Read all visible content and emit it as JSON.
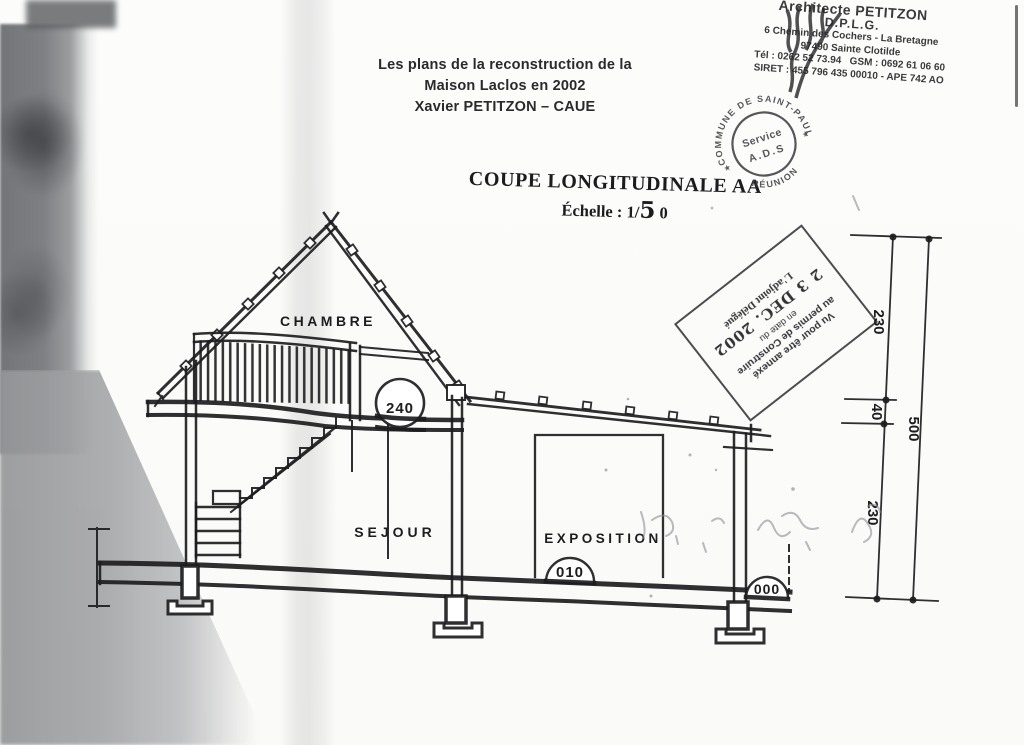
{
  "letterhead": {
    "name": "Architecte PETITZON",
    "dplg": "D.P.L.G.",
    "address1": "6 Chemin des Cochers - La Bretagne",
    "address2": "97490 Sainte Clotilde",
    "phone": "Tél : 0262 52 73.94",
    "gsm": "GSM : 0692 61 06 60",
    "siret": "SIRET : 455 796 435 00010 - APE 742 AO"
  },
  "title_block": {
    "line1": "Les plans de la reconstruction de la",
    "line2": "Maison Laclos en 2002",
    "line3": "Xavier PETITZON – CAUE"
  },
  "drawing": {
    "title": "COUPE LONGITUDINALE AA",
    "scale_prefix": "Échelle : 1/",
    "scale_hand": "5",
    "scale_suffix": "0",
    "rooms": {
      "chambre": "CHAMBRE",
      "sejour": "SEJOUR",
      "exposition": "EXPOSITION"
    },
    "levels": {
      "mezzanine": "240",
      "floor": "010",
      "ground": "000"
    },
    "dims": {
      "upper": "230",
      "middle": "40",
      "lower": "230",
      "total": "500"
    }
  },
  "stamps": {
    "round": {
      "arc_top": "COMMUNE DE SAINT-PAUL",
      "arc_bottom": "RÉUNION",
      "inner1": "Service",
      "inner2": "A.D.S",
      "star": "★"
    },
    "date": {
      "line1": "Vu pour être annexé",
      "line2": "au permis de Construire",
      "line3": "en date du",
      "date_value": "2 3 DEC. 2002",
      "line4": "L'adjoint Délégué"
    }
  }
}
